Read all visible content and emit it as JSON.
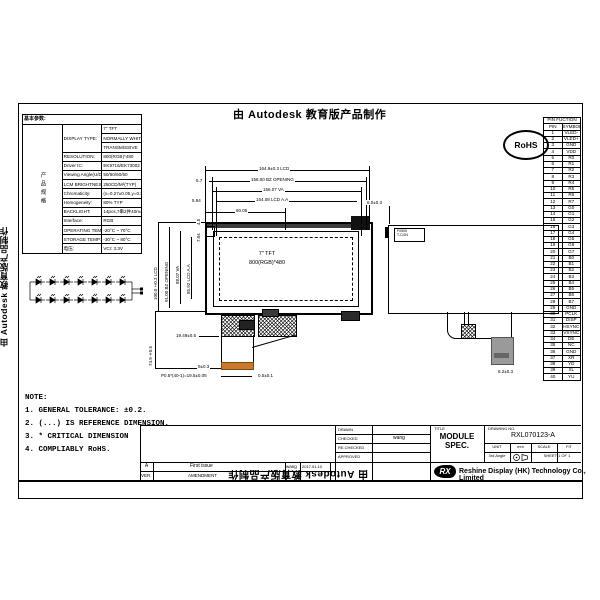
{
  "watermark": {
    "text": "由 Autodesk 教育版产品制作"
  },
  "rohs_label": "RoHS",
  "spec_table": {
    "side_label": "产品规格",
    "header": "基本参数:",
    "rows": [
      {
        "label": "DISPLAY TYPE:",
        "values": [
          "7\" TFT",
          "NORMALLY WHITE",
          "TRANSMISSIVE"
        ]
      },
      {
        "label": "RESOLUTION:",
        "values": [
          "800(RGB)*480"
        ]
      },
      {
        "label": "Driver IC:",
        "values": [
          "EK9716/EK73002"
        ]
      },
      {
        "label": "Viewing Angle(U/D/L/R)",
        "values": [
          "50/60/60/60"
        ]
      },
      {
        "label": "LCM BRIGHTNESS:",
        "values": [
          "250CD/M²(TYP)"
        ]
      },
      {
        "label": "Chromaticity:",
        "values": [
          "(x=0.27±0.05,y=0.31±0.05)"
        ]
      },
      {
        "label": "Homogeneity:",
        "values": [
          "80% TYP"
        ]
      },
      {
        "label": "BACKLIGHT:",
        "values": [
          "14pcs,7串2并40mA(White/LED)"
        ]
      },
      {
        "label": "Interface:",
        "values": [
          "RGB"
        ]
      },
      {
        "label": "OPERATING TEMP:",
        "values": [
          "-20°C ~ 70°C"
        ]
      },
      {
        "label": "STORAGE TEMP:",
        "values": [
          "-30°C ~ 80°C"
        ]
      },
      {
        "label": "电压:",
        "values": [
          "VCI: 3.3V"
        ]
      }
    ]
  },
  "pin_table": {
    "title": "PIN FUCTION",
    "col_pin": "PIN",
    "col_symbol": "SYMBOL",
    "pins": [
      "VLED-",
      "VLED+",
      "GND",
      "VDD",
      "R0",
      "R1",
      "R2",
      "R3",
      "R4",
      "R5",
      "R6",
      "R7",
      "G0",
      "G1",
      "G2",
      "G3",
      "G4",
      "G5",
      "G6",
      "G7",
      "B0",
      "B1",
      "B2",
      "B3",
      "B4",
      "B5",
      "B6",
      "B7",
      "GND",
      "PCLK",
      "DISP",
      "HSYNC",
      "VSYNC",
      "DE",
      "NC",
      "GND",
      "XR",
      "YD",
      "XL",
      "YU"
    ]
  },
  "front_view": {
    "screen_label_1": "7\" TFT",
    "screen_label_2": "800(RGB)*480",
    "dims_top": [
      {
        "text": "164.9±0.3 LCD"
      },
      {
        "text": "158.00 BZ OPENING",
        "offset": "5.7"
      },
      {
        "text": "156.07 VA"
      },
      {
        "text": "154.08 LCD A.A",
        "offset": "5.94"
      },
      {
        "text": "80.05"
      }
    ],
    "dims_left": [
      "100.0±0.3 LCD",
      "91.00 BZ OPENING",
      "88.07 VA",
      "85.92 LCD A.A"
    ],
    "dims_small": [
      "4.5",
      "7.04"
    ],
    "fpc_dims": {
      "height": "74.9±0.5",
      "width": "19.49±0.5",
      "tail": "9±0.3",
      "pitch": "P0.5*(40-1)=19.5±0.05",
      "end": "0.5±0.1"
    }
  },
  "back_view": {
    "sticker_line1": "F0505",
    "sticker_line2": "T-CON",
    "dim_top": "6.0±0.3",
    "dim_bottom": "6.2±0.3"
  },
  "notes": {
    "title": "NOTE:",
    "items": [
      "1. GENERAL TOLERANCE: ±0.2.",
      "2. (...) IS REFERENCE DIMENSION.",
      "3. * CRITICAL DIMENSION",
      "4. COMPLIABLY RoHS."
    ]
  },
  "title_block": {
    "title_label": "TITLE",
    "title": "MODULE SPEC.",
    "drawing_no_label": "DRAWING NO.",
    "drawing_no": "RXL070123-A",
    "unit_label": "UNIT",
    "unit_value": "mm",
    "scale_label": "SCALE",
    "fit_label": "FIT",
    "angle": "3rd Angle",
    "sheet": "SHEET 1 OF 1",
    "logo": "RX",
    "company": "Reshine Display (HK) Technology Co., Limited",
    "approval_rows": [
      {
        "label": "DRAWN",
        "value": ""
      },
      {
        "label": "CHECKED",
        "value": "wang"
      },
      {
        "label": "RE.CHECKED",
        "value": ""
      },
      {
        "label": "APPROVED",
        "value": ""
      }
    ],
    "revision": {
      "ver": "A",
      "desc": "First issue",
      "name": "wang",
      "date": "2017.01.10",
      "ver_label": "VER.",
      "desc_label": "AMENDMENT"
    }
  }
}
